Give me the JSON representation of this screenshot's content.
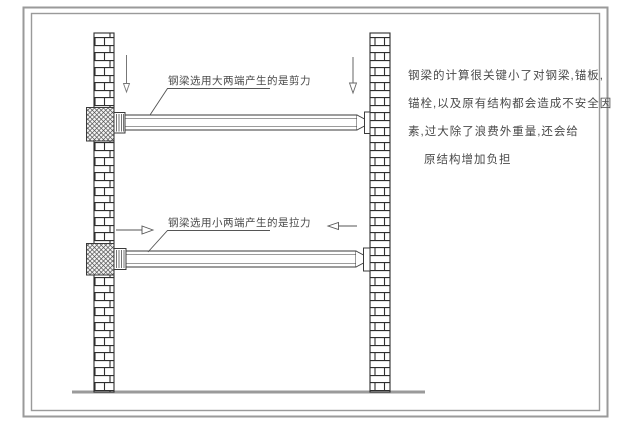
{
  "figure": {
    "type": "engineering-structural-diagram",
    "upper_beam_label": "钢梁选用大两端产生的是剪力",
    "lower_beam_label": "钢梁选用小两端产生的是拉力",
    "note_lines": [
      "钢梁的计算很关键小了对钢梁,锚板,",
      "锚栓,以及原有结构都会造成不安全因",
      "素,过大除了浪费外重量,还会给",
      "原结构增加负担"
    ],
    "colors": {
      "drawing_line": "#3a3a3a",
      "frame_gray": "#9a9a9a",
      "ground_gray": "#9a9a9a",
      "text_gray": "#4a4a4a",
      "background": "#ffffff"
    }
  }
}
